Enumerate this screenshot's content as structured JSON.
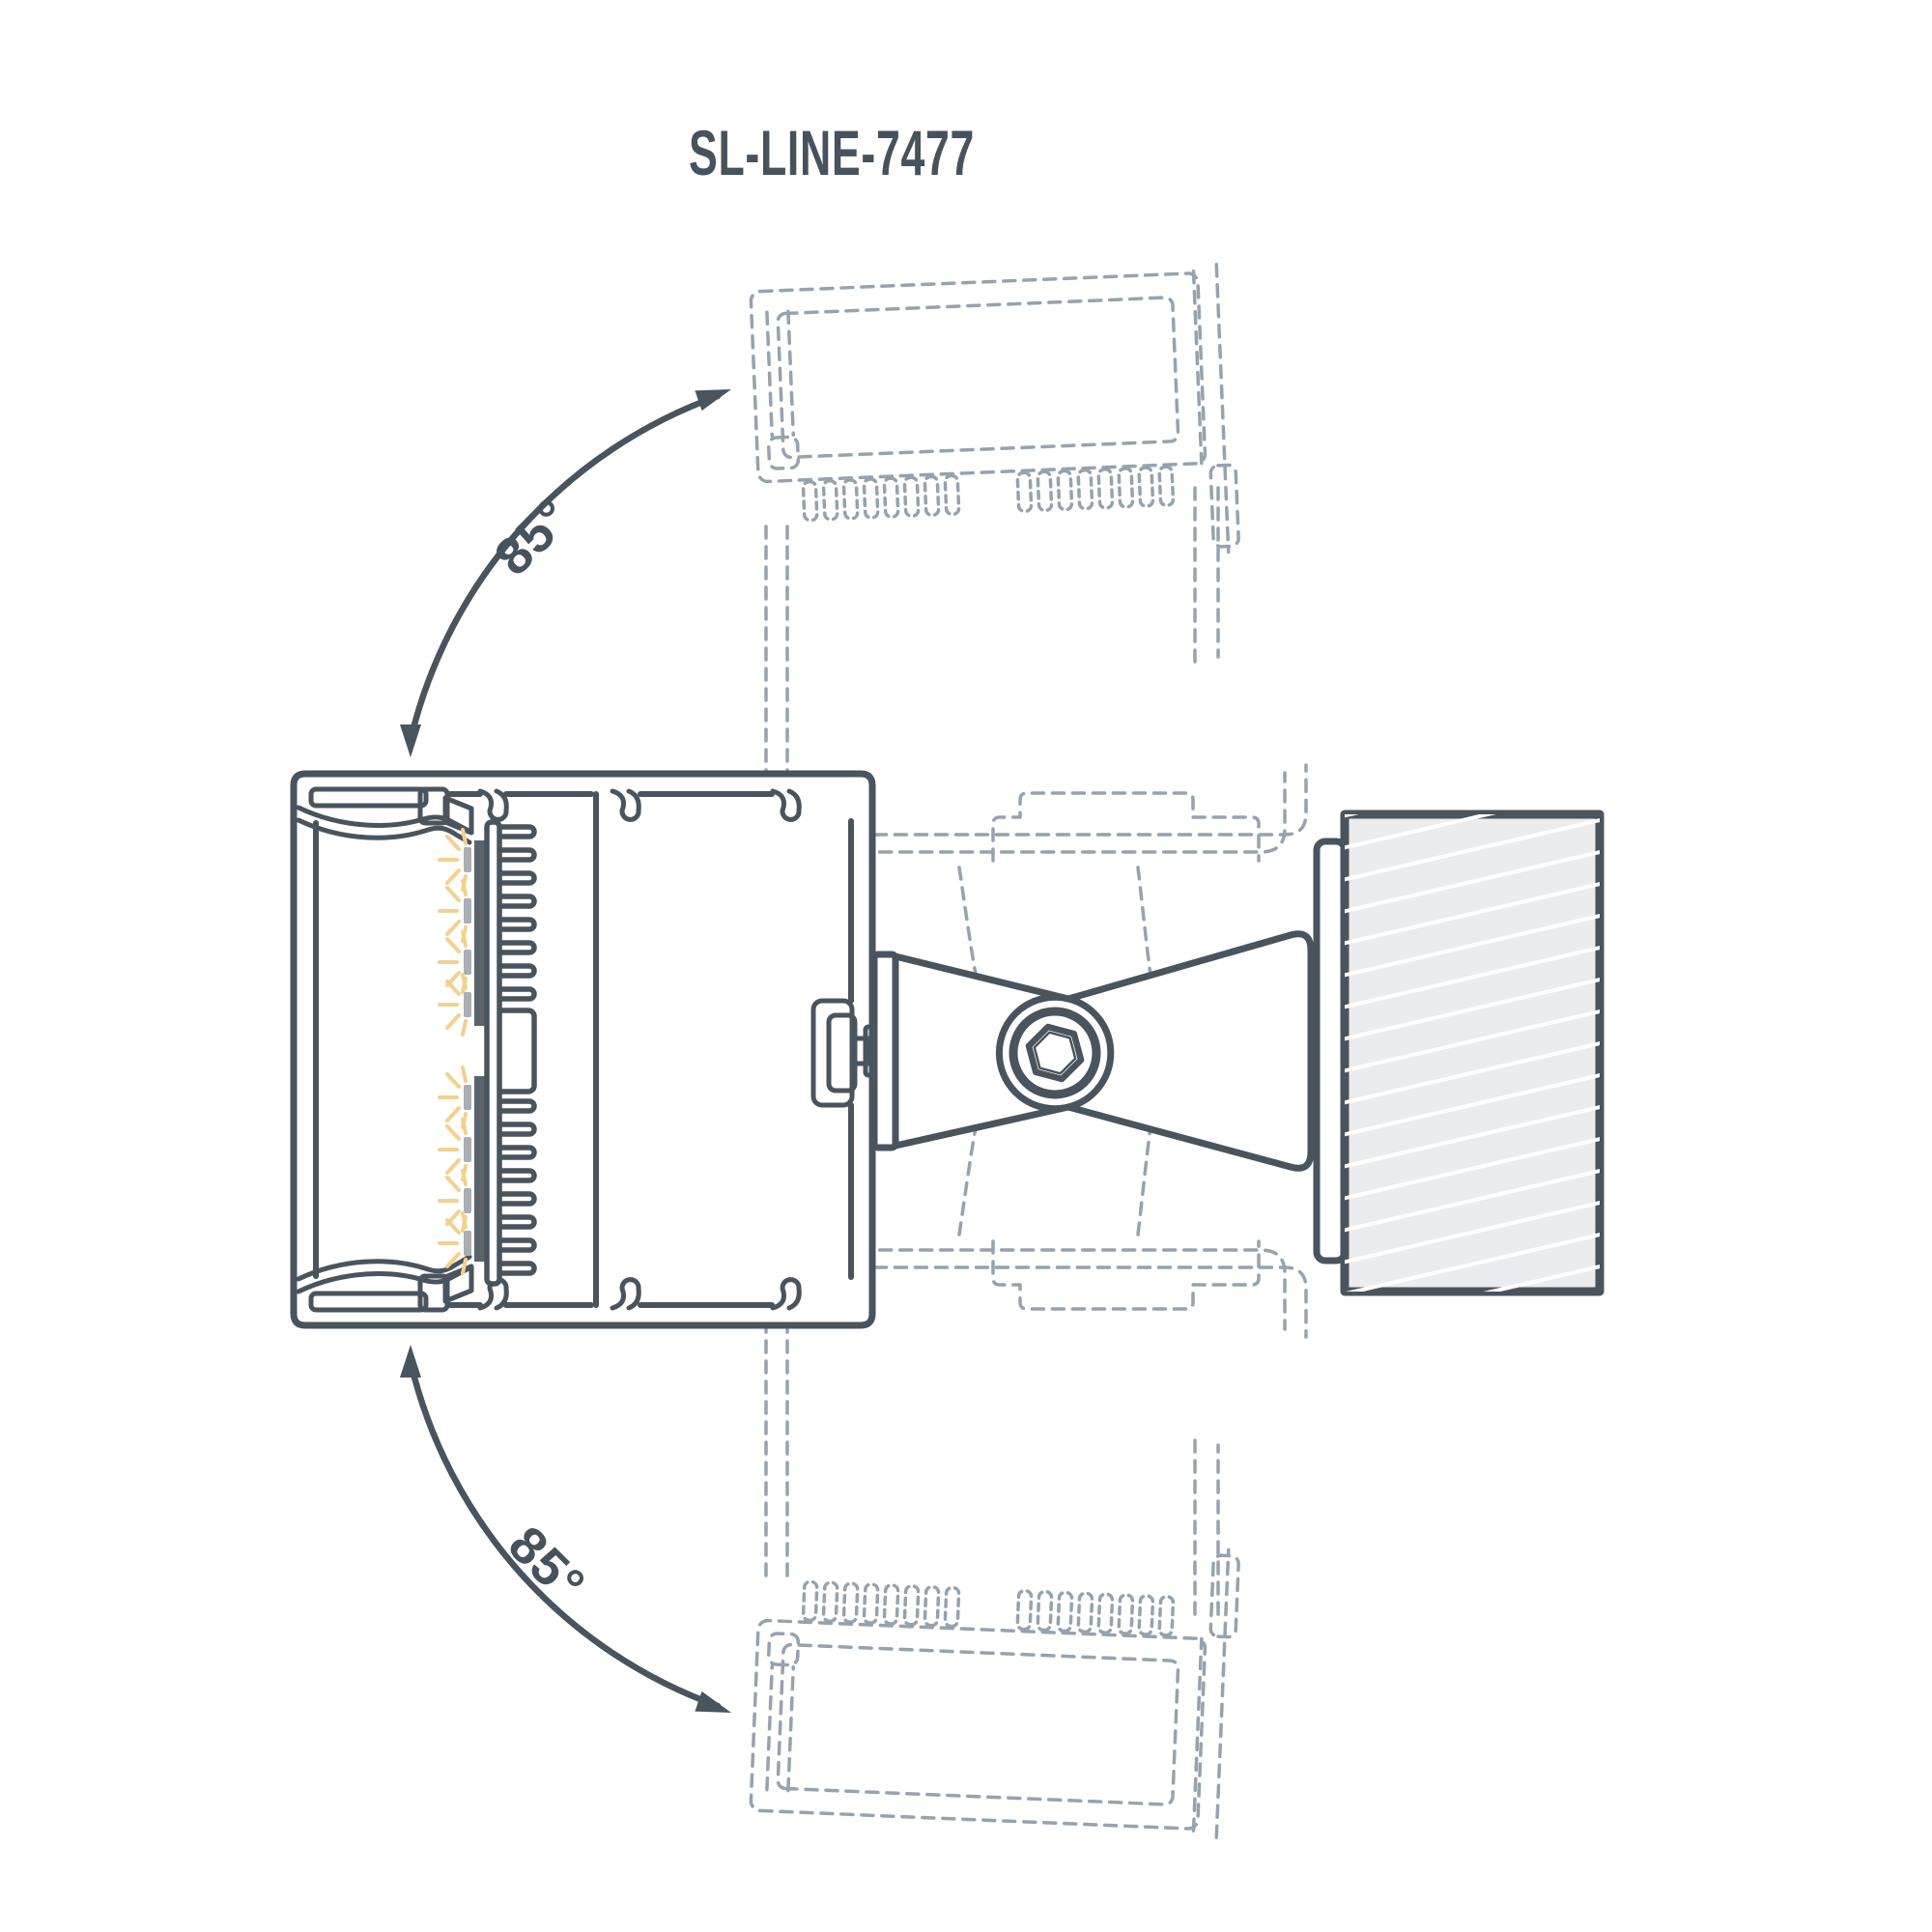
{
  "title": "SL-LINE-7477",
  "angle_labels": {
    "top": "85°",
    "bottom": "85°"
  },
  "drawing": {
    "type": "technical-line-diagram",
    "subject": "adjustable wall-mounted linear LED luminaire cross-section with rotation range",
    "rotation_range_degrees": 85,
    "colors": {
      "line": "#4a545c",
      "ghost_dashed": "#95a3ae",
      "led_glow": "#f3d18e",
      "led_chip": "#a9aeb4",
      "led_strip": "#5b636c",
      "wall_fill": "#ebecee",
      "wall_hatch": "#ffffff",
      "background": "#ffffff"
    },
    "icons": [
      "rotation-arrow-icon",
      "led-glow-icon",
      "hex-socket-screw-icon"
    ]
  }
}
